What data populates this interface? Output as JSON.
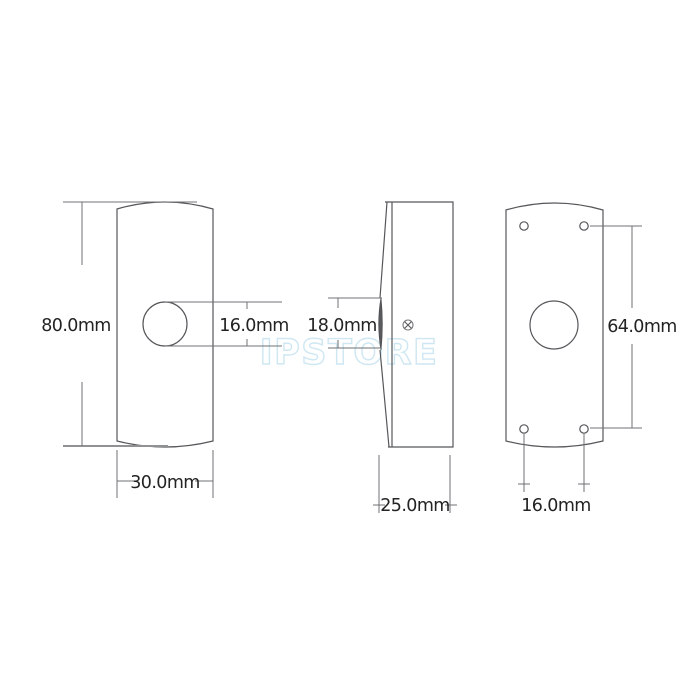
{
  "watermark": {
    "text": "IPSTORE",
    "stroke_color": "#cfe7f2"
  },
  "drawing": {
    "outline_color": "#56575a",
    "dimension_line_color": "#6f7073",
    "label_color": "#232323",
    "views": {
      "front": {
        "dimensions": {
          "height": "80.0mm",
          "button_diameter": "16.0mm",
          "width": "30.0mm"
        }
      },
      "side": {
        "dimensions": {
          "button_height": "18.0mm",
          "depth": "25.0mm"
        }
      },
      "back": {
        "dimensions": {
          "hole_vertical_spacing": "64.0mm",
          "hole_horizontal_spacing": "16.0mm"
        }
      }
    }
  }
}
